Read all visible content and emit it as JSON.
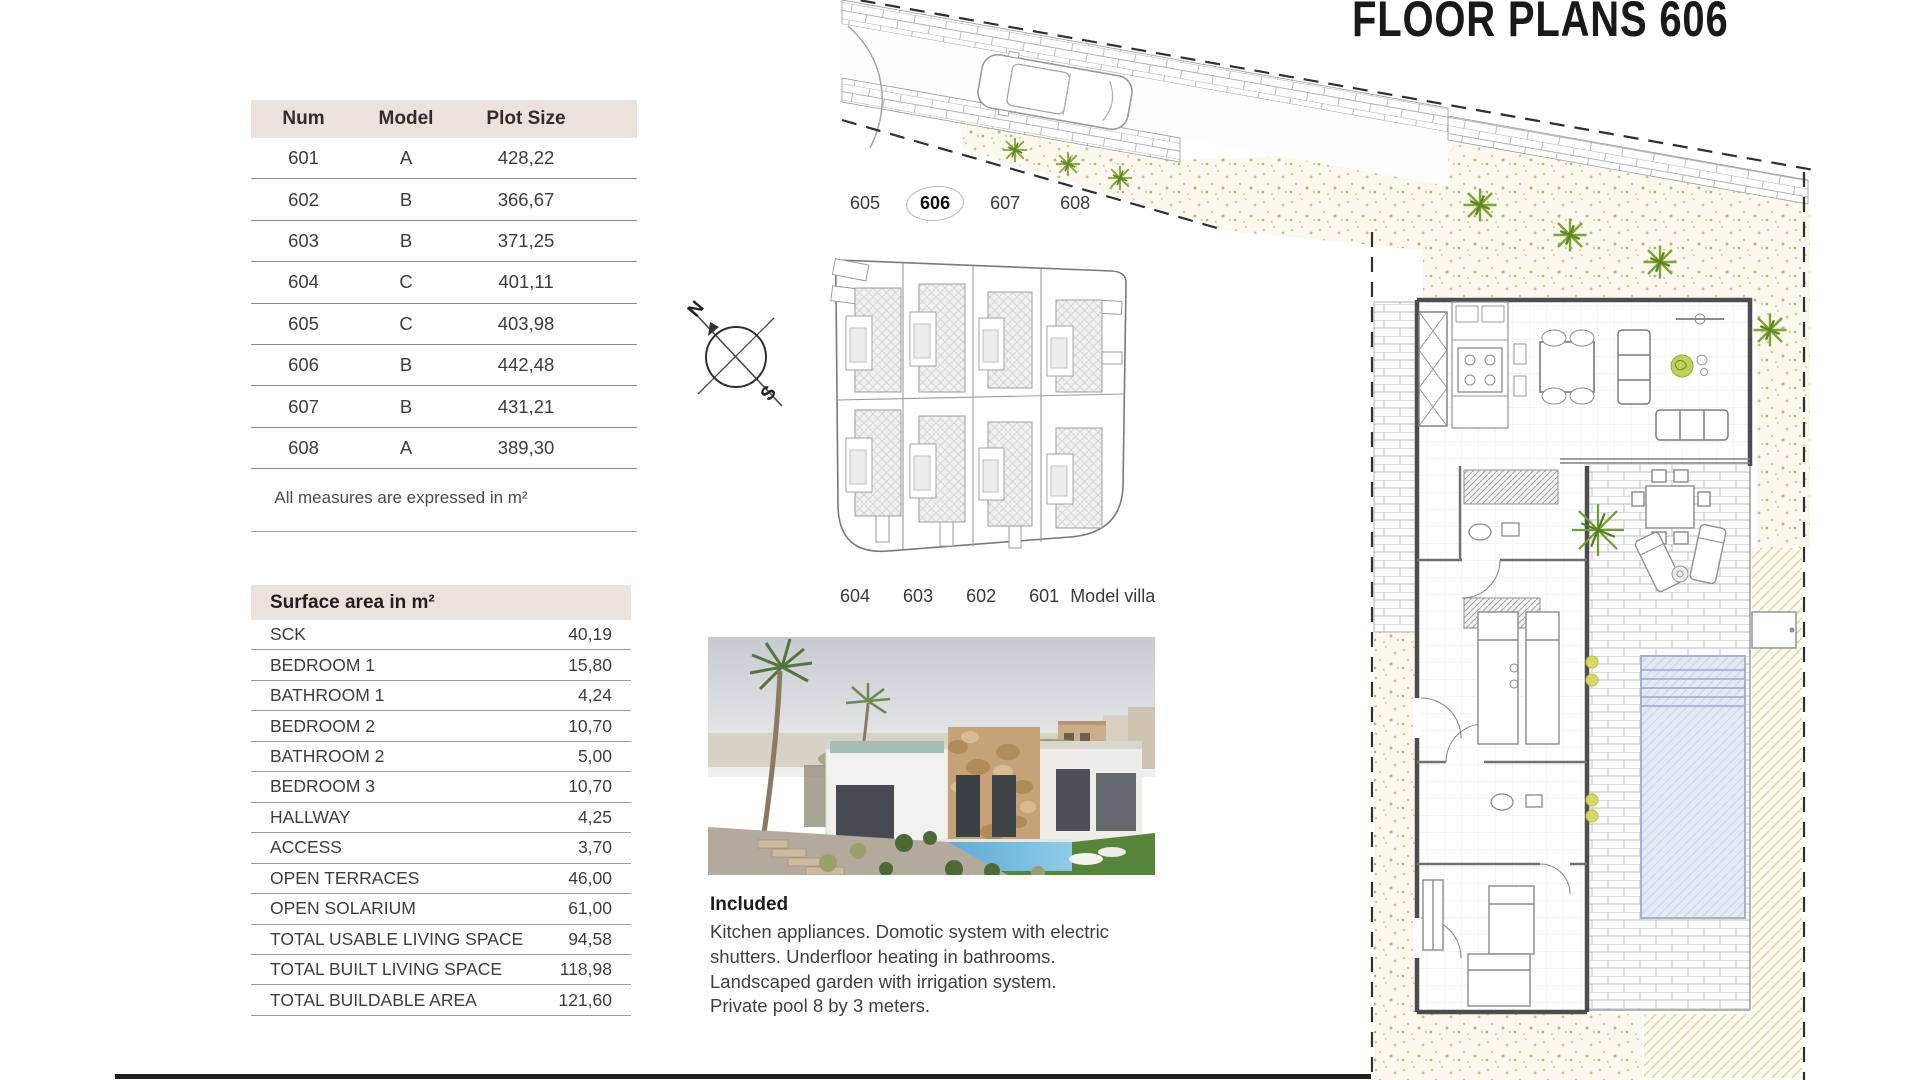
{
  "title": "FLOOR PLANS 606",
  "plot_table": {
    "headers": [
      "Num",
      "Model",
      "Plot Size"
    ],
    "rows": [
      [
        "601",
        "A",
        "428,22"
      ],
      [
        "602",
        "B",
        "366,67"
      ],
      [
        "603",
        "B",
        "371,25"
      ],
      [
        "604",
        "C",
        "401,11"
      ],
      [
        "605",
        "C",
        "403,98"
      ],
      [
        "606",
        "B",
        "442,48"
      ],
      [
        "607",
        "B",
        "431,21"
      ],
      [
        "608",
        "A",
        "389,30"
      ]
    ],
    "note": "All measures are expressed in m²"
  },
  "surface_table": {
    "title": "Surface area in m²",
    "rows": [
      {
        "label": "SCK",
        "value": "40,19"
      },
      {
        "label": "BEDROOM 1",
        "value": "15,80"
      },
      {
        "label": "BATHROOM 1",
        "value": "4,24"
      },
      {
        "label": "BEDROOM 2",
        "value": "10,70"
      },
      {
        "label": "BATHROOM 2",
        "value": "5,00"
      },
      {
        "label": "BEDROOM 3",
        "value": "10,70"
      },
      {
        "label": "HALLWAY",
        "value": "4,25"
      },
      {
        "label": "ACCESS",
        "value": "3,70"
      },
      {
        "label": "OPEN TERRACES",
        "value": "46,00"
      },
      {
        "label": "OPEN SOLARIUM",
        "value": "61,00"
      },
      {
        "label": "TOTAL USABLE LIVING SPACE",
        "value": "94,58"
      },
      {
        "label": "TOTAL BUILT LIVING SPACE",
        "value": "118,98"
      },
      {
        "label": "TOTAL BUILDABLE AREA",
        "value": "121,60"
      }
    ]
  },
  "site_plan": {
    "top_labels": [
      "605",
      "606",
      "607",
      "608"
    ],
    "highlighted_unit": "606",
    "bottom_labels": [
      "604",
      "603",
      "602",
      "601"
    ],
    "model_label": "Model villa",
    "compass": {
      "north": "N",
      "south": "S"
    }
  },
  "included": {
    "heading": "Included",
    "lines": [
      "Kitchen appliances. Domotic system with electric",
      "shutters. Underfloor heating in bathrooms.",
      "Landscaped garden with irrigation system.",
      "Private pool 8 by 3 meters."
    ]
  },
  "colors": {
    "header_beige": "#EBE3DB",
    "line_gray": "#8C8C8C",
    "text_dark": "#3C3C3C",
    "plant_green": "#7FA335",
    "pool_blue": "#DDE6F1",
    "garden_cream": "#FBF9ED"
  }
}
